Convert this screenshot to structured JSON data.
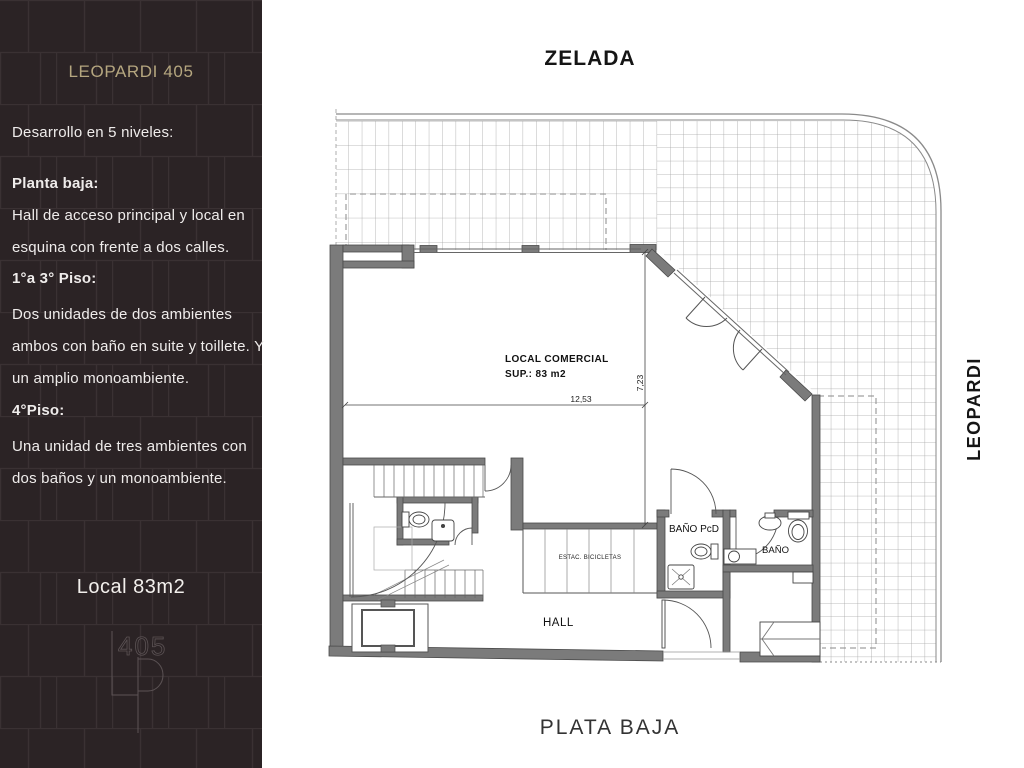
{
  "sidebar": {
    "title": "LEOPARDI 405",
    "lines": [
      {
        "text": "Desarrollo en 5 niveles:"
      },
      {
        "text": "Planta baja:"
      },
      {
        "text": "Hall de acceso principal y local en"
      },
      {
        "text": "esquina con frente a dos calles."
      },
      {
        "text": "1°a 3° Piso:"
      },
      {
        "text": "Dos unidades de dos ambientes"
      },
      {
        "text": "ambos con baño en suite y toillete. Y"
      },
      {
        "text": "un amplio monoambiente."
      },
      {
        "text": "4°Piso:"
      },
      {
        "text": "Una unidad de tres ambientes con"
      },
      {
        "text": "dos baños y un monoambiente."
      }
    ],
    "local_label": "Local 83m2",
    "logo_number": "405"
  },
  "plan": {
    "street_top": "ZELADA",
    "street_right": "LEOPARDI",
    "caption": "PLATA BAJA",
    "labels": {
      "local_line1": "LOCAL COMERCIAL",
      "local_line2": "SUP.: 83 m2",
      "bike": "ESTAC. BICICLETAS",
      "bano_pcd": "BAÑO PcD",
      "bano": "BAÑO",
      "hall": "HALL"
    },
    "dims": {
      "width": "12,53",
      "depth": "7,23"
    }
  },
  "colors": {
    "sidebar_bg": "#2b2325",
    "accent_tan": "#b5a67f",
    "wall_gray": "#7b7b7b",
    "line_dark": "#4a4a4a"
  }
}
